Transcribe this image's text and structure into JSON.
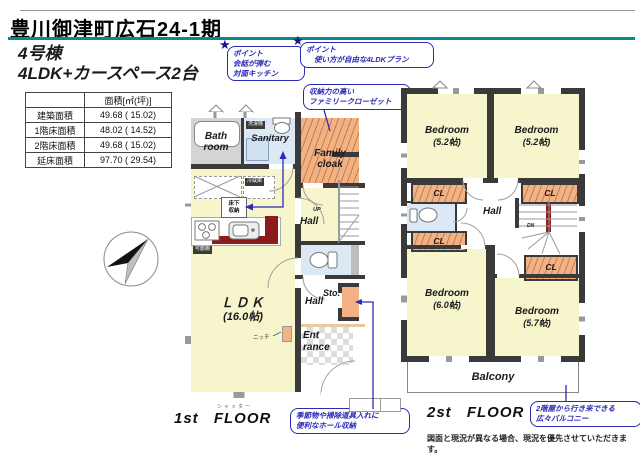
{
  "colors": {
    "accent_teal": "#0a8a8a",
    "callout_blue": "#2a2ab2",
    "wall_dark": "#3a3a3a",
    "floor_yellow": "#f7f5cb",
    "closet_orange": "#f4b183",
    "water_blue": "#dce9f5",
    "counter_red": "#8e1b1b",
    "bath_gray": "#d4d4d4"
  },
  "header": {
    "title": "豊川御津町広石24-1期"
  },
  "subtitle": {
    "line1": "4号棟",
    "line2": "4LDK+カースペース2台"
  },
  "area_table": {
    "col_header": "面積[㎡(坪)]",
    "rows": [
      {
        "label": "建築面積",
        "value": "49.68 ( 15.02)"
      },
      {
        "label": "1階床面積",
        "value": "48.02 ( 14.52)"
      },
      {
        "label": "2階床面積",
        "value": "49.68 ( 15.02)"
      },
      {
        "label": "延床面積",
        "value": "97.70 ( 29.54)"
      }
    ]
  },
  "icons": {
    "star": "★"
  },
  "callouts": {
    "kitchen": {
      "tag": "ポイント",
      "line1": "会話が弾む",
      "line2": "対面キッチン"
    },
    "plan": {
      "tag": "ポイント",
      "line1": "使い方が自由な4LDKプラン"
    },
    "family_closet": {
      "line1": "収納力の高い",
      "line2": "ファミリークローゼット"
    },
    "hall_storage": {
      "line1": "季節物や掃除道具入れに",
      "line2": "便利なホール収納"
    },
    "balcony": {
      "line1": "2階屋から行き来できる",
      "line2": "広々バルコニー"
    }
  },
  "floor1": {
    "label": "1st FLOOR",
    "bath": {
      "line1": "Bath",
      "line2": "room"
    },
    "sanitary": "Sanitary",
    "washer": "洗濯機",
    "family": {
      "line1": "Family",
      "line2": "cloak"
    },
    "fridge": "冷蔵庫",
    "underfloor": {
      "line1": "床下",
      "line2": "収納"
    },
    "shelf": "可動棚",
    "ldk": {
      "line1": "ＬＤＫ",
      "line2": "(16.0帖)"
    },
    "hall_upper": "Hall",
    "up": "UP",
    "sto": "Sto.",
    "hall_lower": "Hall",
    "entrance": {
      "line1": "Ent",
      "line2": "rance"
    },
    "niche": "ニッチ",
    "shutter": "シャッター"
  },
  "floor2": {
    "label": "2st FLOOR",
    "closet": "CL",
    "hall": "Hall",
    "dn": "DN",
    "balcony": "Balcony",
    "bedrooms": [
      {
        "name": "Bedroom",
        "size": "(5.2帖)"
      },
      {
        "name": "Bedroom",
        "size": "(5.2帖)"
      },
      {
        "name": "Bedroom",
        "size": "(6.0帖)"
      },
      {
        "name": "Bedroom",
        "size": "(5.7帖)"
      }
    ]
  },
  "footer": {
    "disclaimer": "図面と現況が異なる場合、現況を優先させていただきます。"
  }
}
